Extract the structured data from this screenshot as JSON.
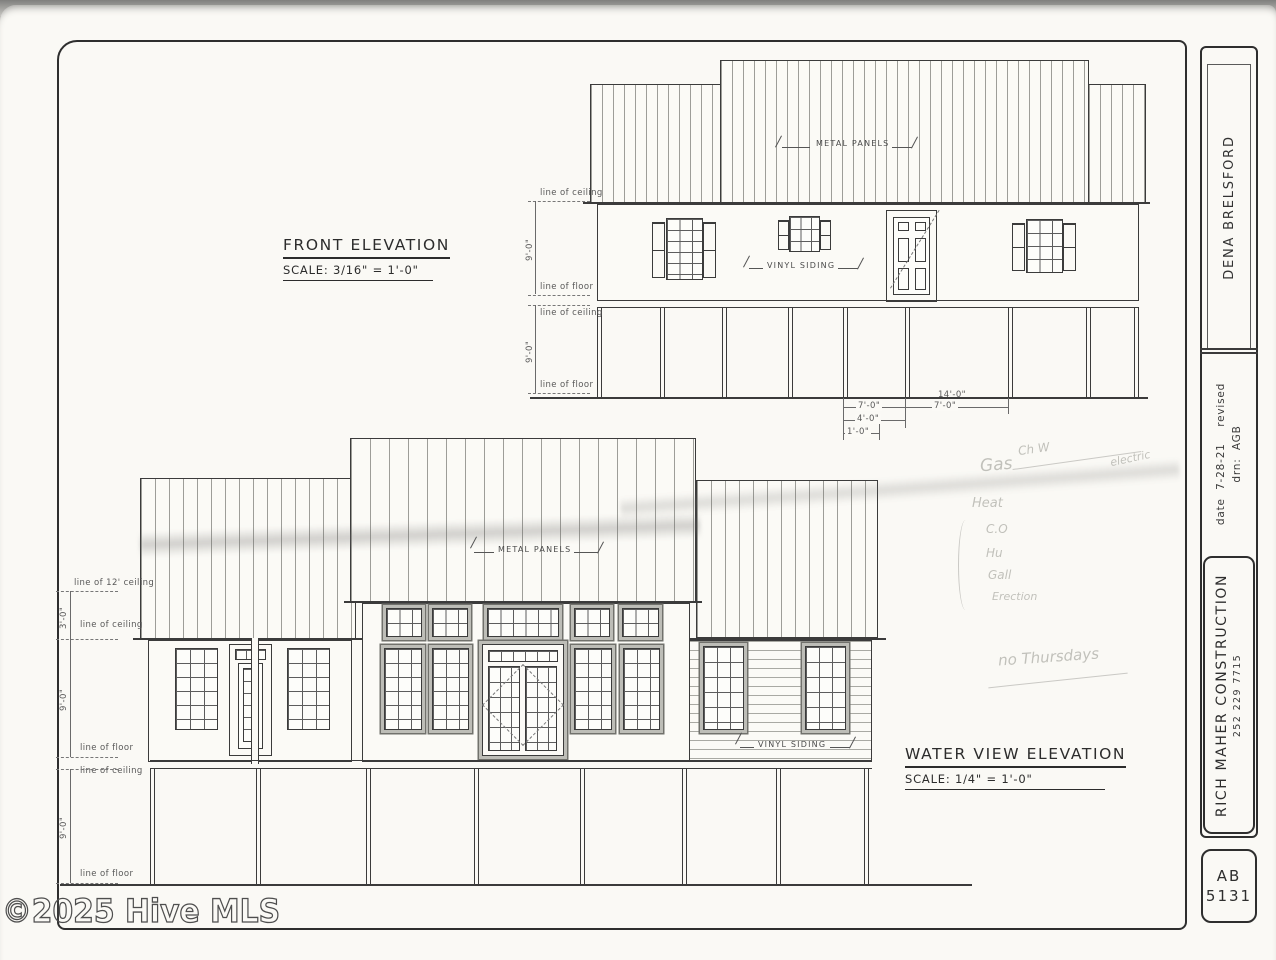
{
  "watermark": "©2025 Hive MLS",
  "front": {
    "title": "FRONT ELEVATION",
    "scale": "SCALE: 3/16\" = 1'-0\"",
    "metal_panels": "METAL PANELS",
    "vinyl_siding": "VINYL SIDING",
    "dims": [
      "line of ceiling",
      "9'-0\"",
      "line of floor",
      "line of ceiling",
      "9'-0\"",
      "line of floor"
    ],
    "bottom_dims": [
      "14'-0\"",
      "7'-0\"",
      "7'-0\"",
      "4'-0\"",
      "1'-0\""
    ]
  },
  "water": {
    "title": "WATER VIEW ELEVATION",
    "scale": "SCALE: 1/4\" = 1'-0\"",
    "metal_panels": "METAL PANELS",
    "vinyl_siding": "VINYL SIDING",
    "dims": [
      "line of 12' ceiling",
      "3'-0\"",
      "line of ceiling",
      "9'-0\"",
      "line of floor",
      "line of ceiling",
      "9'-0\"",
      "line of floor"
    ]
  },
  "title_block": {
    "client": "DENA BRELSFORD",
    "date_label": "date",
    "date_value": "7-28-21",
    "revised_label": "revised",
    "drawn_label": "drn:",
    "drawn_value": "AGB",
    "company": "RICH MAHER CONSTRUCTION",
    "phone": "252 229 7715",
    "sheet_prefix": "AB",
    "sheet_number": "5131"
  },
  "notes": [
    "Gas",
    "Ch W",
    "electric",
    "Heat",
    "C.O",
    "Hu",
    "Gall",
    "Erection",
    "no Thursdays"
  ]
}
